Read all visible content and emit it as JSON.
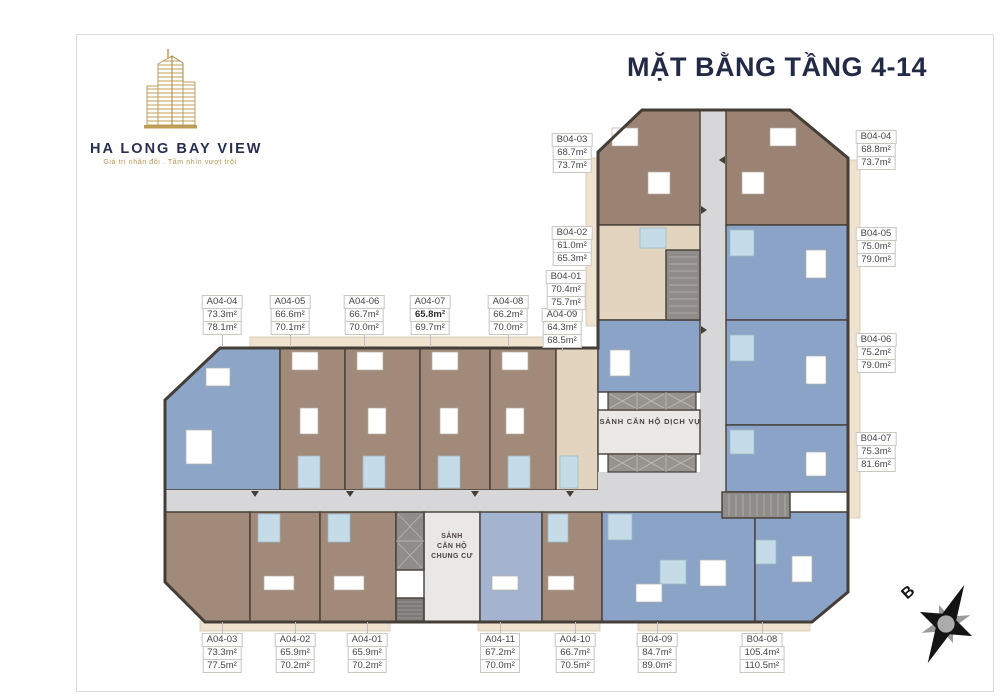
{
  "page": {
    "title": "MẶT BẰNG TẦNG 4-14"
  },
  "logo": {
    "name": "HA LONG BAY VIEW",
    "tagline": "Giá trị nhân đôi . Tầm nhìn vượt trội"
  },
  "plan": {
    "service_lobby": "SẢNH CĂN HỘ DỊCH VỤ",
    "residential_lobby_lines": [
      "SẢNH",
      "CĂN HỘ",
      "CHUNG CƯ"
    ],
    "compass_label": "B"
  },
  "colors": {
    "accent_navy": "#232a45",
    "gold": "#b6954f",
    "unit_brown": "#a18a79",
    "unit_blue": "#8ba3c7",
    "unit_blue_light": "#a4b4d0",
    "unit_beige": "#e3d4c0",
    "corridor_gray": "#d7d7d9",
    "bathroom_blue": "#c6dbe8",
    "wall": "#453e37"
  },
  "units": [
    {
      "code": "A04-04",
      "area1": "73.3m²",
      "area2": "78.1m²"
    },
    {
      "code": "A04-05",
      "area1": "66.6m²",
      "area2": "70.1m²"
    },
    {
      "code": "A04-06",
      "area1": "66.7m²",
      "area2": "70.0m²"
    },
    {
      "code": "A04-07",
      "area1": "65.8m²",
      "area2": "69.7m²",
      "area1_bold": true
    },
    {
      "code": "A04-08",
      "area1": "66.2m²",
      "area2": "70.0m²"
    },
    {
      "code": "A04-09",
      "area1": "64.3m²",
      "area2": "68.5m²"
    },
    {
      "code": "B04-03",
      "area1": "68.7m²",
      "area2": "73.7m²"
    },
    {
      "code": "B04-02",
      "area1": "61.0m²",
      "area2": "65.3m²"
    },
    {
      "code": "B04-01",
      "area1": "70.4m²",
      "area2": "75.7m²"
    },
    {
      "code": "B04-04",
      "area1": "68.8m²",
      "area2": "73.7m²"
    },
    {
      "code": "B04-05",
      "area1": "75.0m²",
      "area2": "79.0m²"
    },
    {
      "code": "B04-06",
      "area1": "75.2m²",
      "area2": "79.0m²"
    },
    {
      "code": "B04-07",
      "area1": "75.3m²",
      "area2": "81.6m²"
    },
    {
      "code": "A04-03",
      "area1": "73.3m²",
      "area2": "77.5m²"
    },
    {
      "code": "A04-02",
      "area1": "65.9m²",
      "area2": "70.2m²"
    },
    {
      "code": "A04-01",
      "area1": "65.9m²",
      "area2": "70.2m²"
    },
    {
      "code": "A04-11",
      "area1": "67.2m²",
      "area2": "70.0m²"
    },
    {
      "code": "A04-10",
      "area1": "66.7m²",
      "area2": "70.5m²"
    },
    {
      "code": "B04-09",
      "area1": "84.7m²",
      "area2": "89.0m²"
    },
    {
      "code": "B04-08",
      "area1": "105.4m²",
      "area2": "110.5m²"
    }
  ]
}
